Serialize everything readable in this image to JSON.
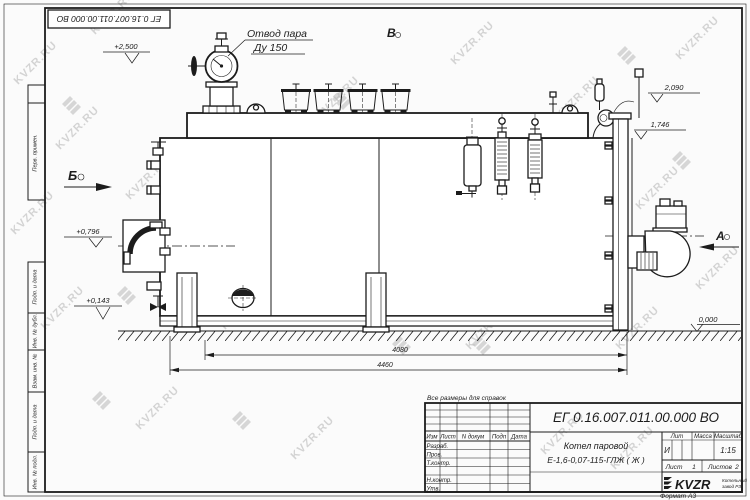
{
  "doc_number": "ЕГ 0.16.007.011.00.000 ВО",
  "watermark": {
    "text": "KVZR.RU"
  },
  "colors": {
    "line": "#1c1c1c",
    "watermark": "#b3b3b3",
    "paper": "#fbfbfb"
  },
  "frame": {
    "margin_labels": [
      "Перв. примен.",
      "Подп. и дата",
      "Инв. № дубл.",
      "Взам. инв. №",
      "Подп. и дата",
      "Инв. № подл."
    ],
    "format_note": "Формат А3"
  },
  "drawing": {
    "callout_line1": "Отвод пара",
    "callout_line2": "Ду 150",
    "view_a": "А",
    "view_b": "Б",
    "view_v": "В",
    "elev_top": "+2,500",
    "elev_2090": "2,090",
    "elev_1746": "1,746",
    "elev_0796": "+0,796",
    "elev_0143": "+0,143",
    "elev_0000": "0,000",
    "dim_4080": "4080",
    "dim_4460": "4460"
  },
  "title_block": {
    "note": "Все размеры для справок",
    "name_line1": "Котел паровой",
    "name_line2": "Е-1,6-0,07-115-ГЛЖ ( Ж )",
    "cols": [
      "Изм",
      "Лист",
      "N докум",
      "Подп",
      "Дата"
    ],
    "rows": [
      "Разраб.",
      "Пров.",
      "Т.контр.",
      "Н.контр.",
      "Утв."
    ],
    "lit_label": "Лит",
    "lit_value": "И",
    "mass_label": "Масса",
    "scale_label": "Масштаб",
    "scale_value": "1:15",
    "sheet_label": "Лист",
    "sheet_value": "1",
    "sheets_label": "Листов",
    "sheets_value": "2",
    "company": "KVZR",
    "company_sub1": "Котельный",
    "company_sub2": "завод РЗ"
  }
}
